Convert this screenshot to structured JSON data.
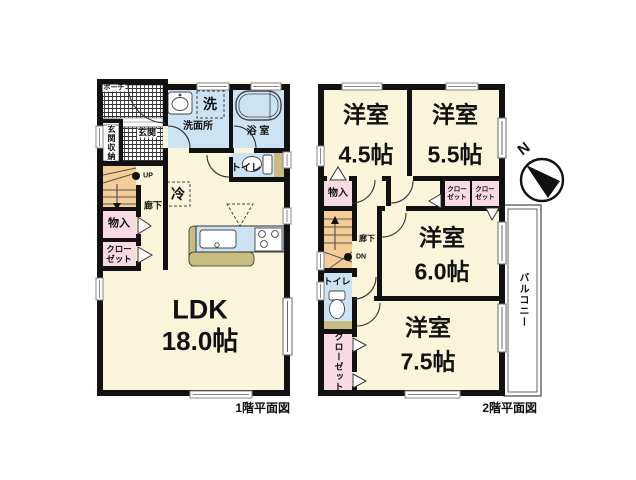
{
  "floor1": {
    "caption": "1階平面図",
    "labels": {
      "porch": "ポーチ",
      "entrance": "玄関",
      "entrance_storage": "玄関収納",
      "washroom": "洗面所",
      "laundry": "洗",
      "bath": "浴 室",
      "toilet": "トイレ",
      "hallway": "廊下",
      "up": "UP",
      "storage": "物入",
      "closet_l1": "クロー",
      "closet_l2": "ゼット",
      "fridge": "冷",
      "ldk_name": "LDK",
      "ldk_size": "18.0帖"
    }
  },
  "floor2": {
    "caption": "2階平面図",
    "labels": {
      "room_a_name": "洋室",
      "room_a_size": "4.5帖",
      "room_b_name": "洋室",
      "room_b_size": "5.5帖",
      "room_c_name": "洋室",
      "room_c_size": "6.0帖",
      "room_d_name": "洋室",
      "room_d_size": "7.5帖",
      "storage": "物入",
      "closet1_l1": "クロー",
      "closet1_l2": "ゼット",
      "closet2_l1": "クロー",
      "closet2_l2": "ゼット",
      "closet_tall": "クローゼット",
      "hallway": "廊下",
      "down": "DN",
      "toilet": "トイレ",
      "balcony": "バルコニー"
    }
  },
  "compass": {
    "north": "N"
  },
  "colors": {
    "room_fill": "#FAF4DA",
    "wet_fill": "#CBE3F2",
    "closet_fill": "#F8DAE3",
    "stairs_fill": "#F5CD96",
    "counter_fill": "#C9BC80",
    "wall": "#111111"
  }
}
